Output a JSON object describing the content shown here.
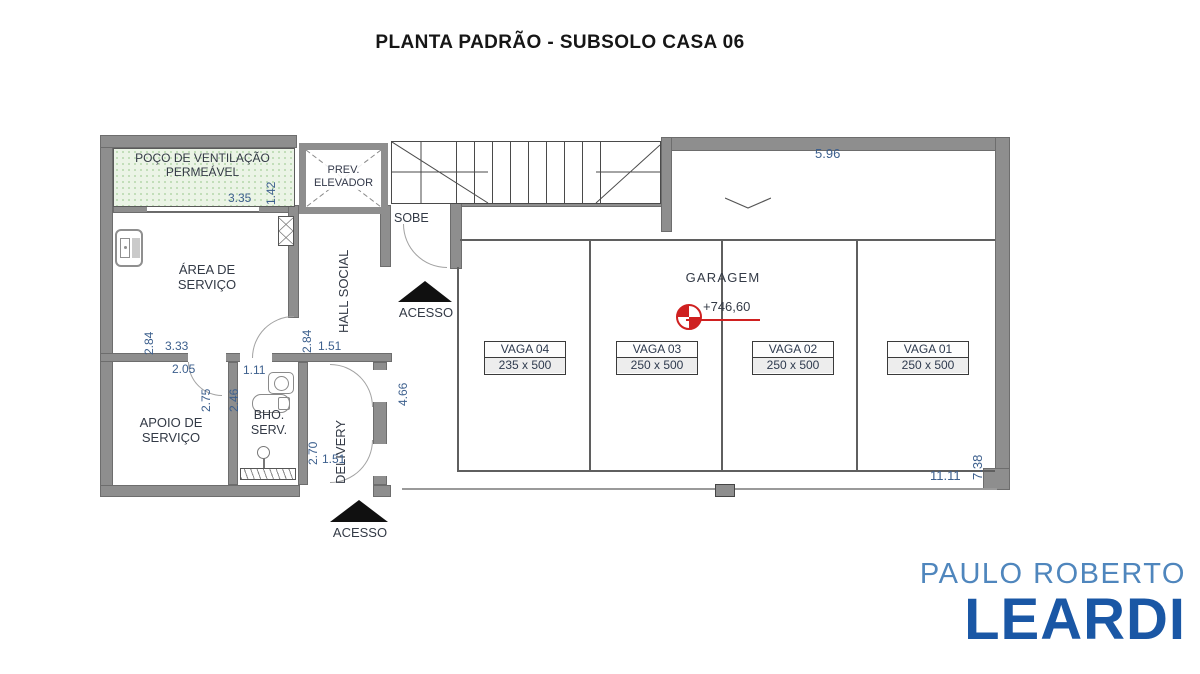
{
  "title": "PLANTA PADRÃO - SUBSOLO CASA 06",
  "plan": {
    "rooms": {
      "poco": "POÇO DE VENTILAÇÃO PERMEÁVEL",
      "elevador": "PREV. ELEVADOR",
      "area_servico": "ÁREA DE SERVIÇO",
      "hall_social": "HALL SOCIAL",
      "apoio_servico": "APOIO DE SERVIÇO",
      "bho_serv": "BHO. SERV.",
      "delivery": "DELIVERY",
      "garagem": "GARAGEM"
    },
    "labels": {
      "sobe": "SOBE",
      "acesso_upper": "ACESSO",
      "acesso_lower": "ACESSO",
      "level": "+746,60"
    },
    "dims": {
      "poco_width": "3.35",
      "poco_height": "1.42",
      "area_servico_height": "2.84",
      "area_servico_width": "3.33",
      "hall_height": "2.84",
      "hall_width": "1.51",
      "apoio_width": "2.05",
      "apoio_height": "2.75",
      "bho_width": "1.11",
      "bho_height": "2.46",
      "delivery_height": "2.70",
      "delivery_width": "1.51",
      "corridor_height": "4.66",
      "driveway_width": "5.96",
      "garage_height": "7.38",
      "garage_width": "11.11"
    },
    "vagas": [
      {
        "name": "VAGA 04",
        "size": "235 x 500"
      },
      {
        "name": "VAGA 03",
        "size": "250 x 500"
      },
      {
        "name": "VAGA 02",
        "size": "250 x 500"
      },
      {
        "name": "VAGA 01",
        "size": "250 x 500"
      }
    ]
  },
  "logo": {
    "top": "PAULO ROBERTO",
    "bottom": "LEARDI"
  },
  "colors": {
    "wall": "#8e8e8e",
    "poco_fill": "#ebf4e6",
    "dimension_text": "#3c5f8d",
    "level_marker_red": "#cf2020",
    "logo_light_blue": "#4f86bd",
    "logo_dark_blue": "#1a57a5"
  }
}
